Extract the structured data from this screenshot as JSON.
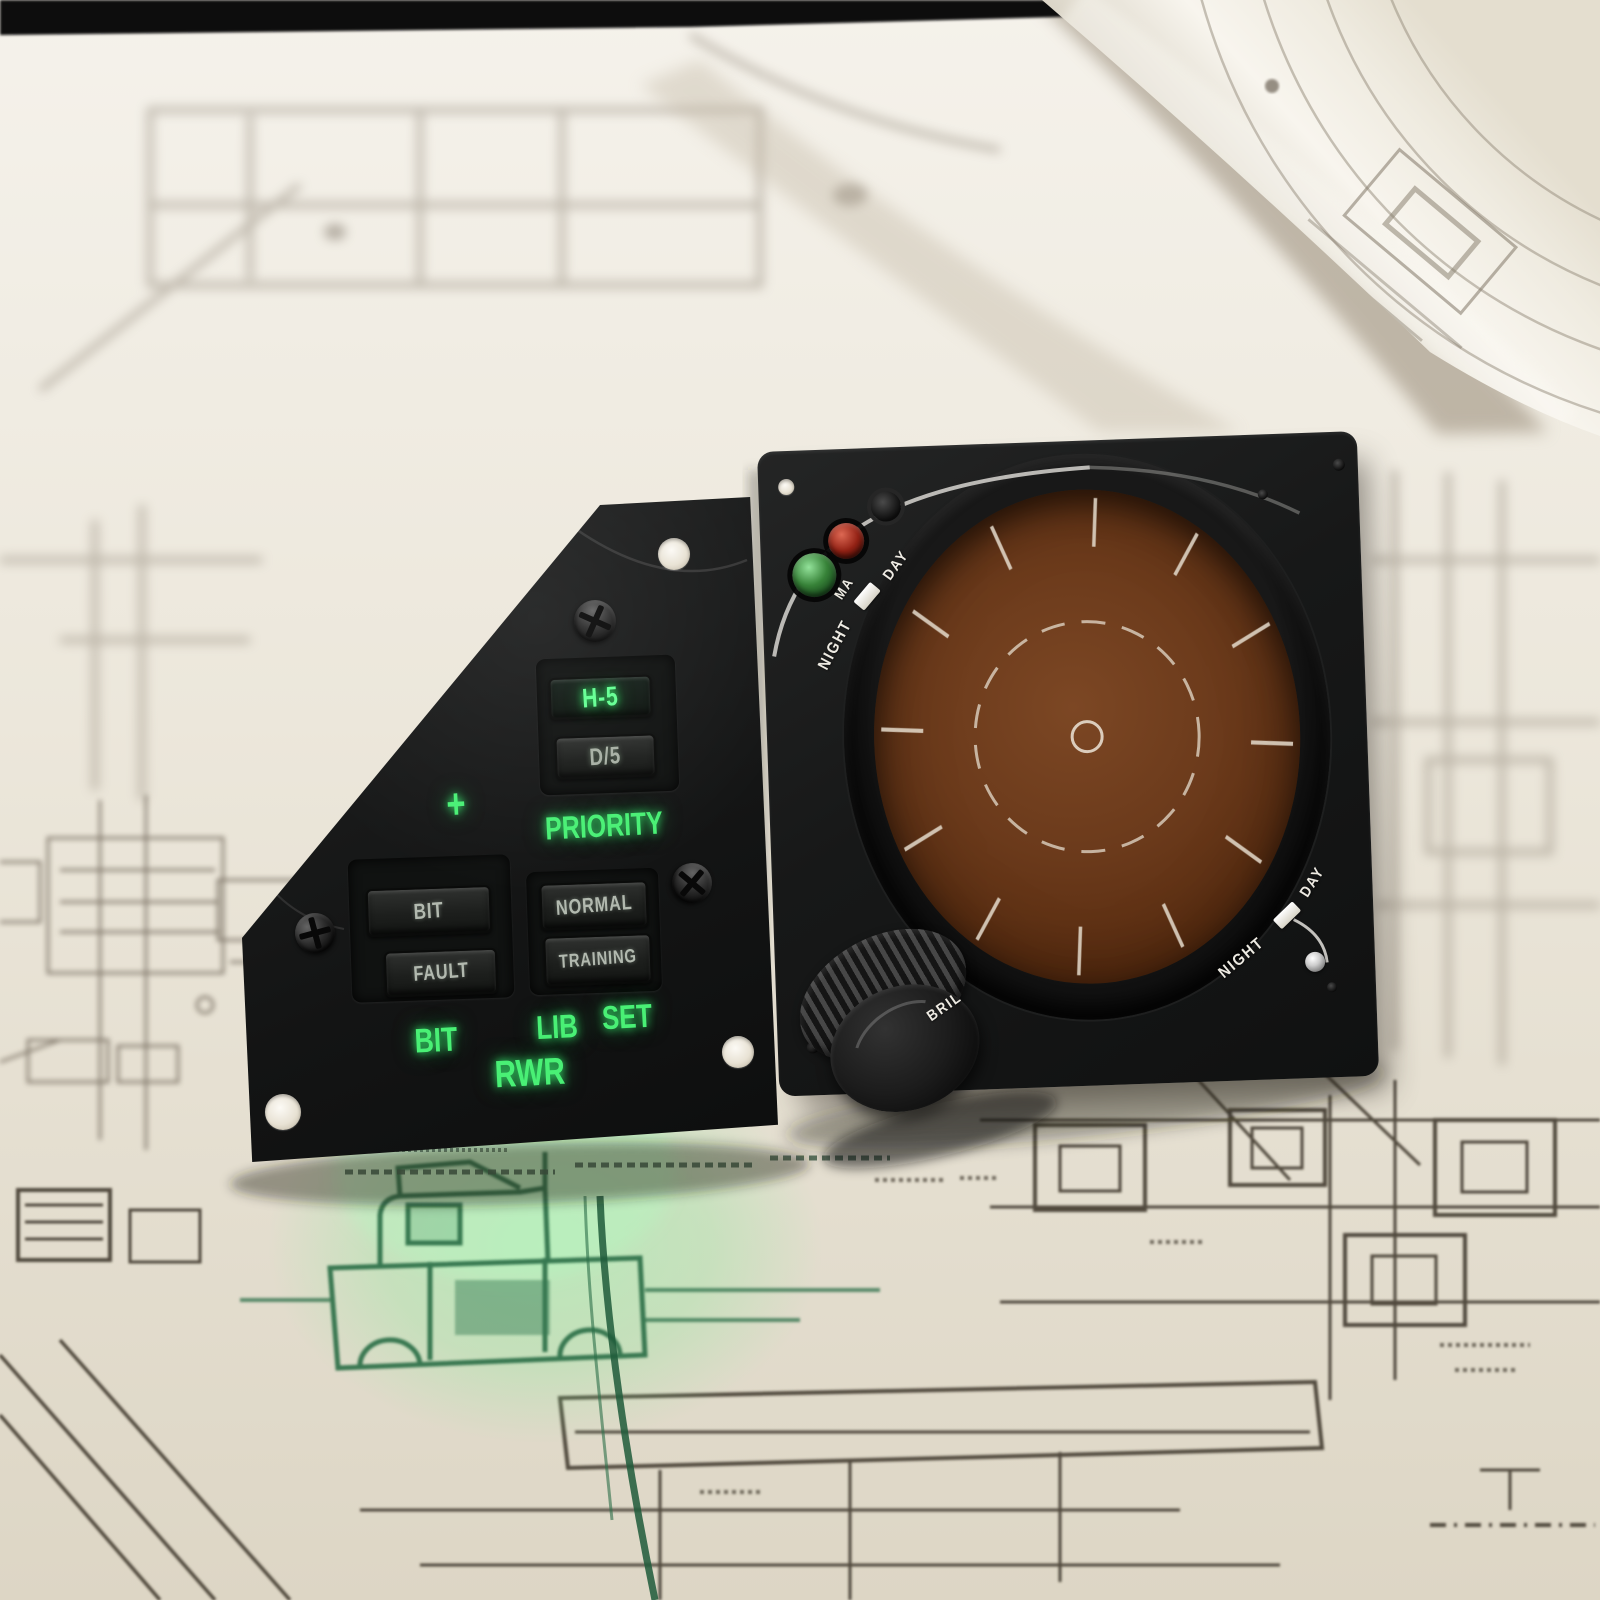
{
  "colors": {
    "glow_green": "#49f075",
    "display_green": "#63ff92",
    "screen_brown": "#6b3a1b",
    "panel_black": "#151616",
    "paper_cream": "#e9e4d8",
    "lamp_green": "#378238",
    "lamp_red": "#932215"
  },
  "rwr_control_panel": {
    "display": {
      "priority_value": "H-5",
      "secondary_value": "D/5"
    },
    "plus_marker": "+",
    "labels": {
      "priority": "PRIORITY",
      "bit": "BIT",
      "lib": "LIB",
      "set": "SET",
      "rwr": "RWR"
    },
    "buttons": {
      "bit": "BIT",
      "fault": "FAULT",
      "normal": "NORMAL",
      "training": "TRAINING"
    }
  },
  "azimuth_display_panel": {
    "dimmer_top": {
      "night": "NIGHT",
      "ma": "MA",
      "day": "DAY"
    },
    "dimmer_bottom": {
      "night": "NIGHT",
      "day": "DAY"
    },
    "knob_label": "BRIL"
  }
}
